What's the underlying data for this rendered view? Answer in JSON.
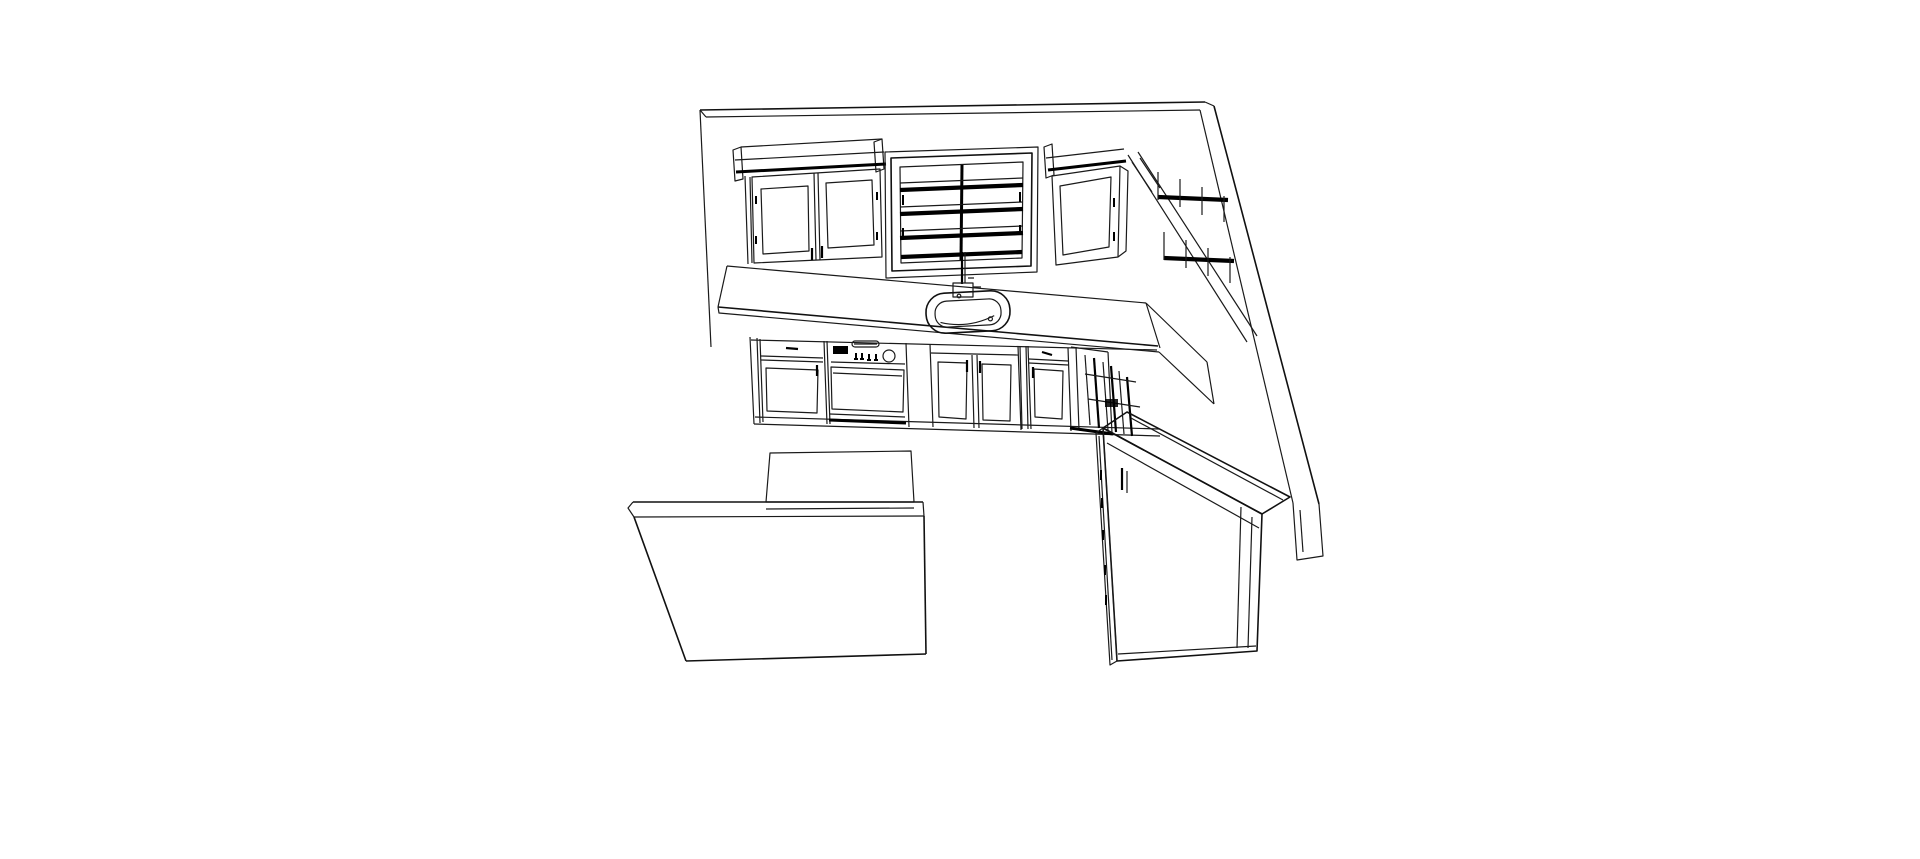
{
  "canvas": {
    "width": 1920,
    "height": 859,
    "background": "#ffffff",
    "line_color": "#000000",
    "title": "Kitchen 3D perspective wireframe drawing"
  },
  "scene": {
    "view": "perspective-from-above-left",
    "style": "black-and-white line drawing",
    "objects": [
      {
        "name": "back-wall"
      },
      {
        "name": "right-wall"
      },
      {
        "name": "wall-cabinet-double-door"
      },
      {
        "name": "window",
        "panes": {
          "cols": 2,
          "rows": 4
        }
      },
      {
        "name": "faucet"
      },
      {
        "name": "kitchen-sink"
      },
      {
        "name": "wall-cabinet-single-door"
      },
      {
        "name": "right-run-wall-cabinets"
      },
      {
        "name": "countertop"
      },
      {
        "name": "base-cabinet-drawer-door"
      },
      {
        "name": "range",
        "knobs": 4,
        "display": 1
      },
      {
        "name": "sink-base-cabinet-double-door"
      },
      {
        "name": "small-base-cabinet"
      },
      {
        "name": "corner-base-cabinet"
      },
      {
        "name": "right-run-base-cabinets"
      },
      {
        "name": "refrigerator"
      },
      {
        "name": "island"
      }
    ]
  }
}
